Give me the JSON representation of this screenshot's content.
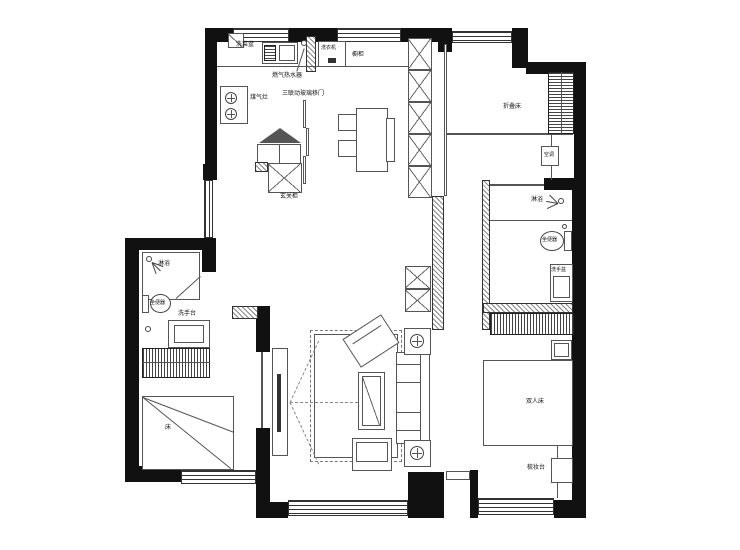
{
  "title": "residential-floor-plan",
  "labels": {
    "sink": "洗菜盆",
    "washing_machine": "洗衣机",
    "cupboard": "橱柜",
    "gas_water_heater": "燃气热水器",
    "gas_stove": "煤气灶",
    "glass_sliding_door": "三联动玻璃移门",
    "entry_cabinet": "玄关柜",
    "folding_bed_room": "折叠床",
    "air_conditioner": "空调",
    "shower_master": "淋浴",
    "toilet_master": "坐便器",
    "washbasin_master": "洗手盆",
    "double_bed": "双人床",
    "dresser": "梳妆台",
    "shower_second": "淋浴",
    "toilet_second": "坐便器",
    "washstand_second": "洗手台",
    "bed_second": "床"
  },
  "colors": {
    "wall": "#111111",
    "line": "#555555",
    "background": "#ffffff"
  }
}
